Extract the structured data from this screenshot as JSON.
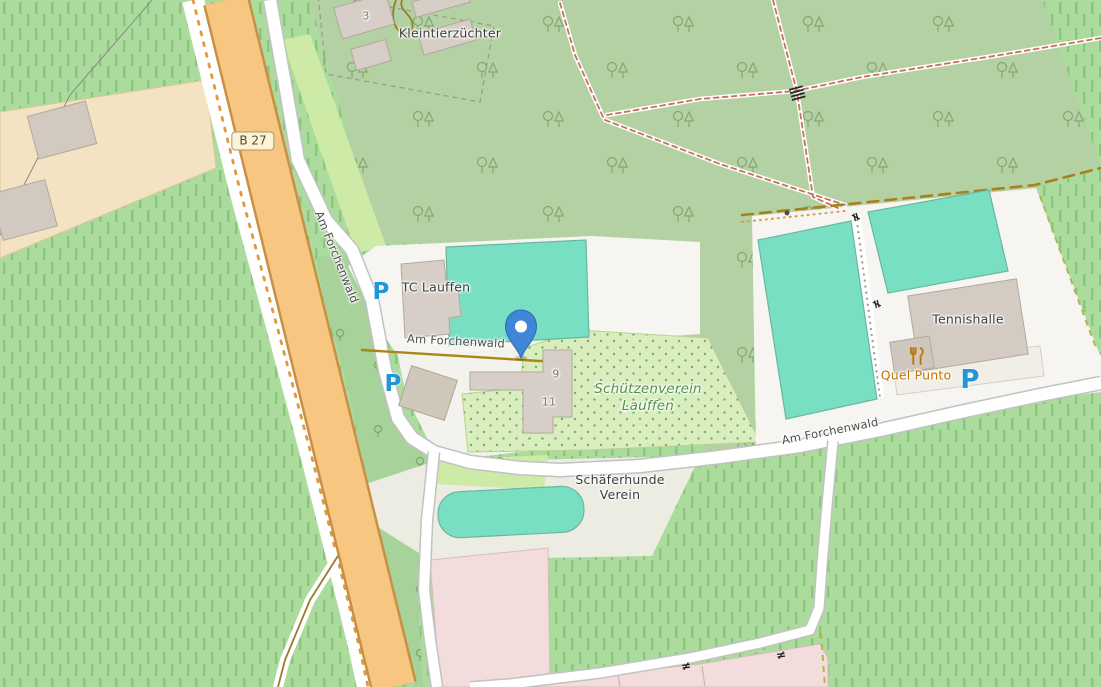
{
  "map_type": "openstreetmap-extract",
  "labels": {
    "allotment": "Kleintierzüchter",
    "allotment_number": "3",
    "route_badge": "B 27",
    "street_north": "Am Forchenwald",
    "street_middle": "Am Forchenwald",
    "street_east": "Am Forchenwald",
    "tc_lauffen": "TC Lauffen",
    "house_9": "9",
    "house_11": "11",
    "schuetzenverein_1": "Schützenverein",
    "schuetzenverein_2": "Lauffen",
    "tennishalle": "Tennishalle",
    "quel_punto": "Quel Punto",
    "schaeferhunde_1": "Schäferhunde",
    "schaeferhunde_2": "Verein",
    "parking_symbol": "P",
    "gate_symbol": "≠"
  },
  "icons": {
    "marker": "location-pin-icon",
    "parking": [
      "parking-icon-tc-lauffen",
      "parking-icon-roadside",
      "parking-icon-tennishalle"
    ],
    "restaurant": "restaurant-icon",
    "steps": "steps-icon",
    "gate": "gate-icon"
  },
  "colors": {
    "road_primary_fill": "#f7c681",
    "road_primary_casing": "#c89045",
    "road_minor_fill": "#ffffff",
    "road_minor_casing": "#c2c2c2",
    "pitch_teal": "#79dfc2",
    "forest_green": "#b3d1a2",
    "vineyard_green": "#abdb9d",
    "grass_green": "#cdeaa6",
    "scrub_green": "#a7d299",
    "allotment_dots_bg": "#d9edbe",
    "building_fill": "#d7cfc7",
    "pink_area": "#f2dcdc",
    "tan_area": "#f4e3c3",
    "compound_gray": "#edece2",
    "pin_blue": "#3f86d6",
    "parking_blue": "#2196d8",
    "poi_orange": "#c07308",
    "area_label_green": "#4d9246",
    "track_brown": "#ab8617"
  }
}
